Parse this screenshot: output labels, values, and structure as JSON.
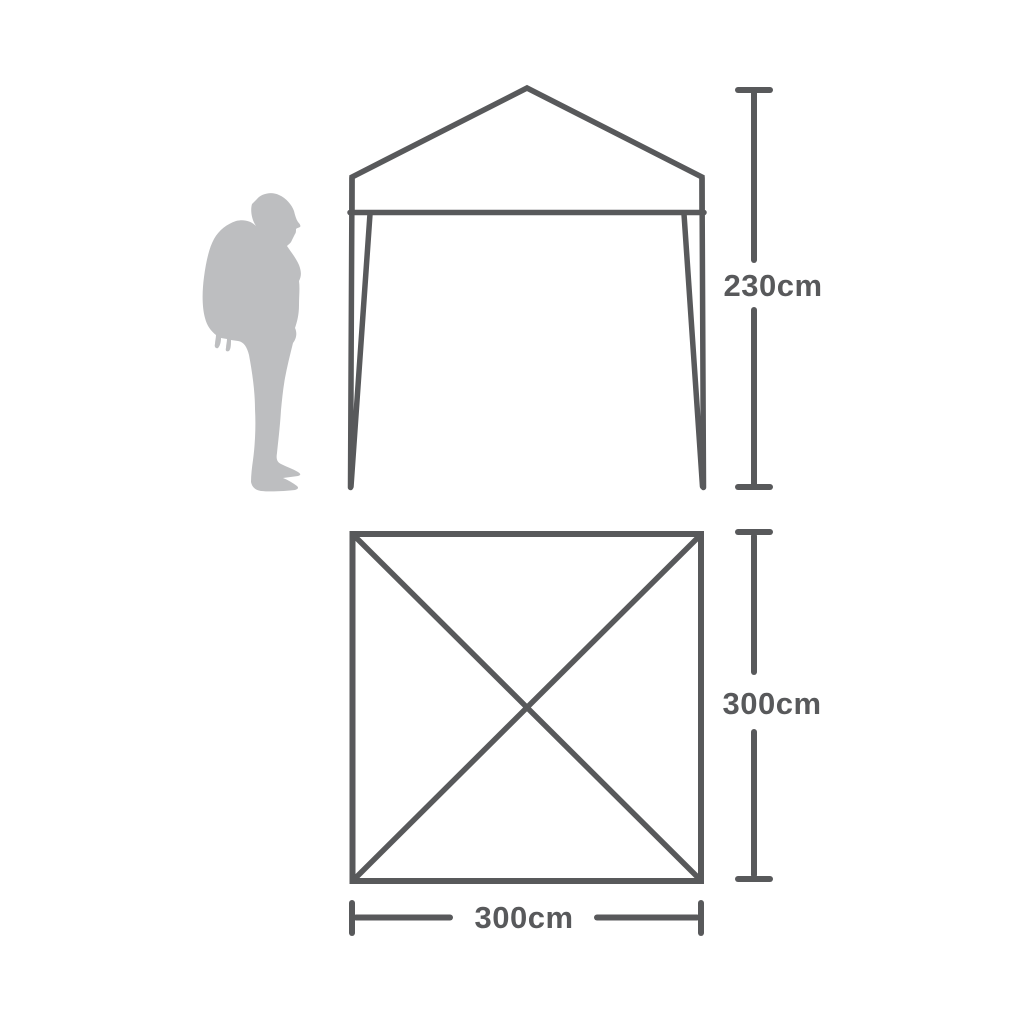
{
  "colors": {
    "line": "#58595B",
    "silhouette": "#BDBEC0",
    "background": "#FFFFFF"
  },
  "front_view": {
    "height_dimension_label": "230cm"
  },
  "plan_view": {
    "side_dimension_label": "300cm",
    "bottom_dimension_label": "300cm"
  },
  "scale_figure": {
    "icon": "hiker-with-backpack-silhouette"
  }
}
